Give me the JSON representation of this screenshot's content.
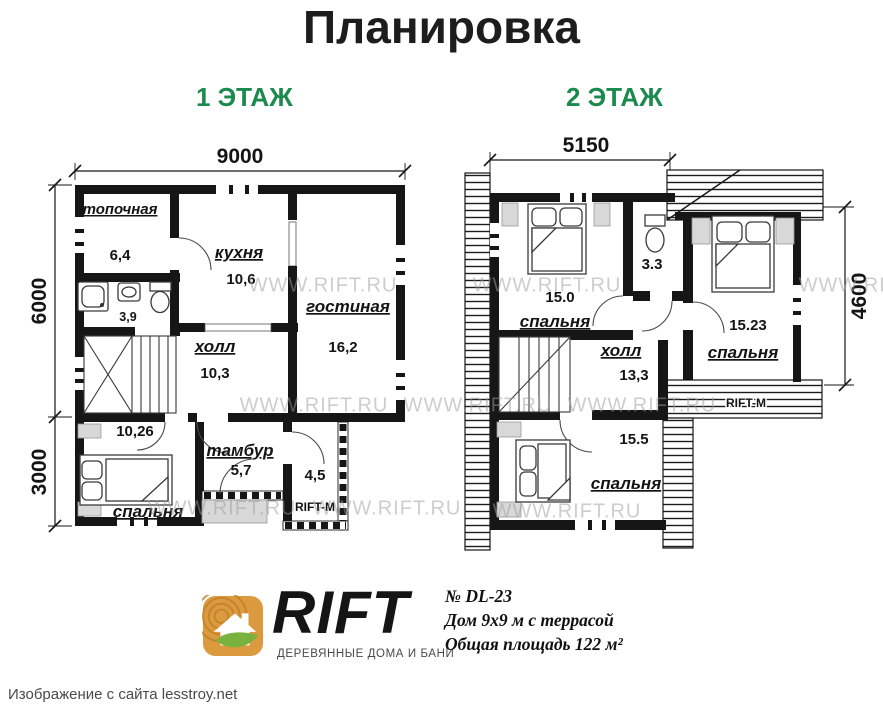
{
  "title": "Планировка",
  "watermark": "WWW.RIFT.RU",
  "floor1": {
    "label": "1 ЭТАЖ",
    "dims": {
      "top": "9000",
      "left_upper": "6000",
      "left_lower": "3000"
    },
    "rooms": {
      "topochnaya": {
        "name": "топочная",
        "area": "6,4"
      },
      "bath": {
        "area": "3,9"
      },
      "kitchen": {
        "name": "кухня",
        "area": "10,6"
      },
      "living": {
        "name": "гостиная",
        "area": "16,2"
      },
      "hall": {
        "name": "холл",
        "area": "10,3"
      },
      "bedroom": {
        "name": "спальня",
        "area": "10,26"
      },
      "tambur": {
        "name": "тамбур",
        "area": "5,7"
      },
      "porch": {
        "area": "4,5",
        "label": "RIFT-M"
      }
    }
  },
  "floor2": {
    "label": "2 ЭТАЖ",
    "dims": {
      "top": "5150",
      "right": "4600"
    },
    "rooms": {
      "bedroom1": {
        "name": "спальня",
        "area": "15.0"
      },
      "wc": {
        "area": "3.3"
      },
      "bedroom2": {
        "name": "спальня",
        "area": "15.23"
      },
      "hall": {
        "name": "холл",
        "area": "13,3"
      },
      "bedroom3": {
        "name": "спальня",
        "area": "15.5"
      },
      "balcony": {
        "label": "RIFT-M"
      }
    }
  },
  "logo": {
    "brand": "RIFT",
    "tagline": "ДЕРЕВЯННЫЕ ДОМА И БАНИ"
  },
  "project": {
    "number": "№ DL-23",
    "description": "Дом 9х9 м с террасой",
    "total_area": "Общая площадь 122 м²"
  },
  "caption": "Изображение с сайта lesstroy.net",
  "colors": {
    "floor_label_green": "#1b8a4e",
    "wall_black": "#161616",
    "watermark_gray": "#9d9d9d",
    "logo_wood": "#dc9a3e",
    "logo_leaf": "#79b23f"
  }
}
